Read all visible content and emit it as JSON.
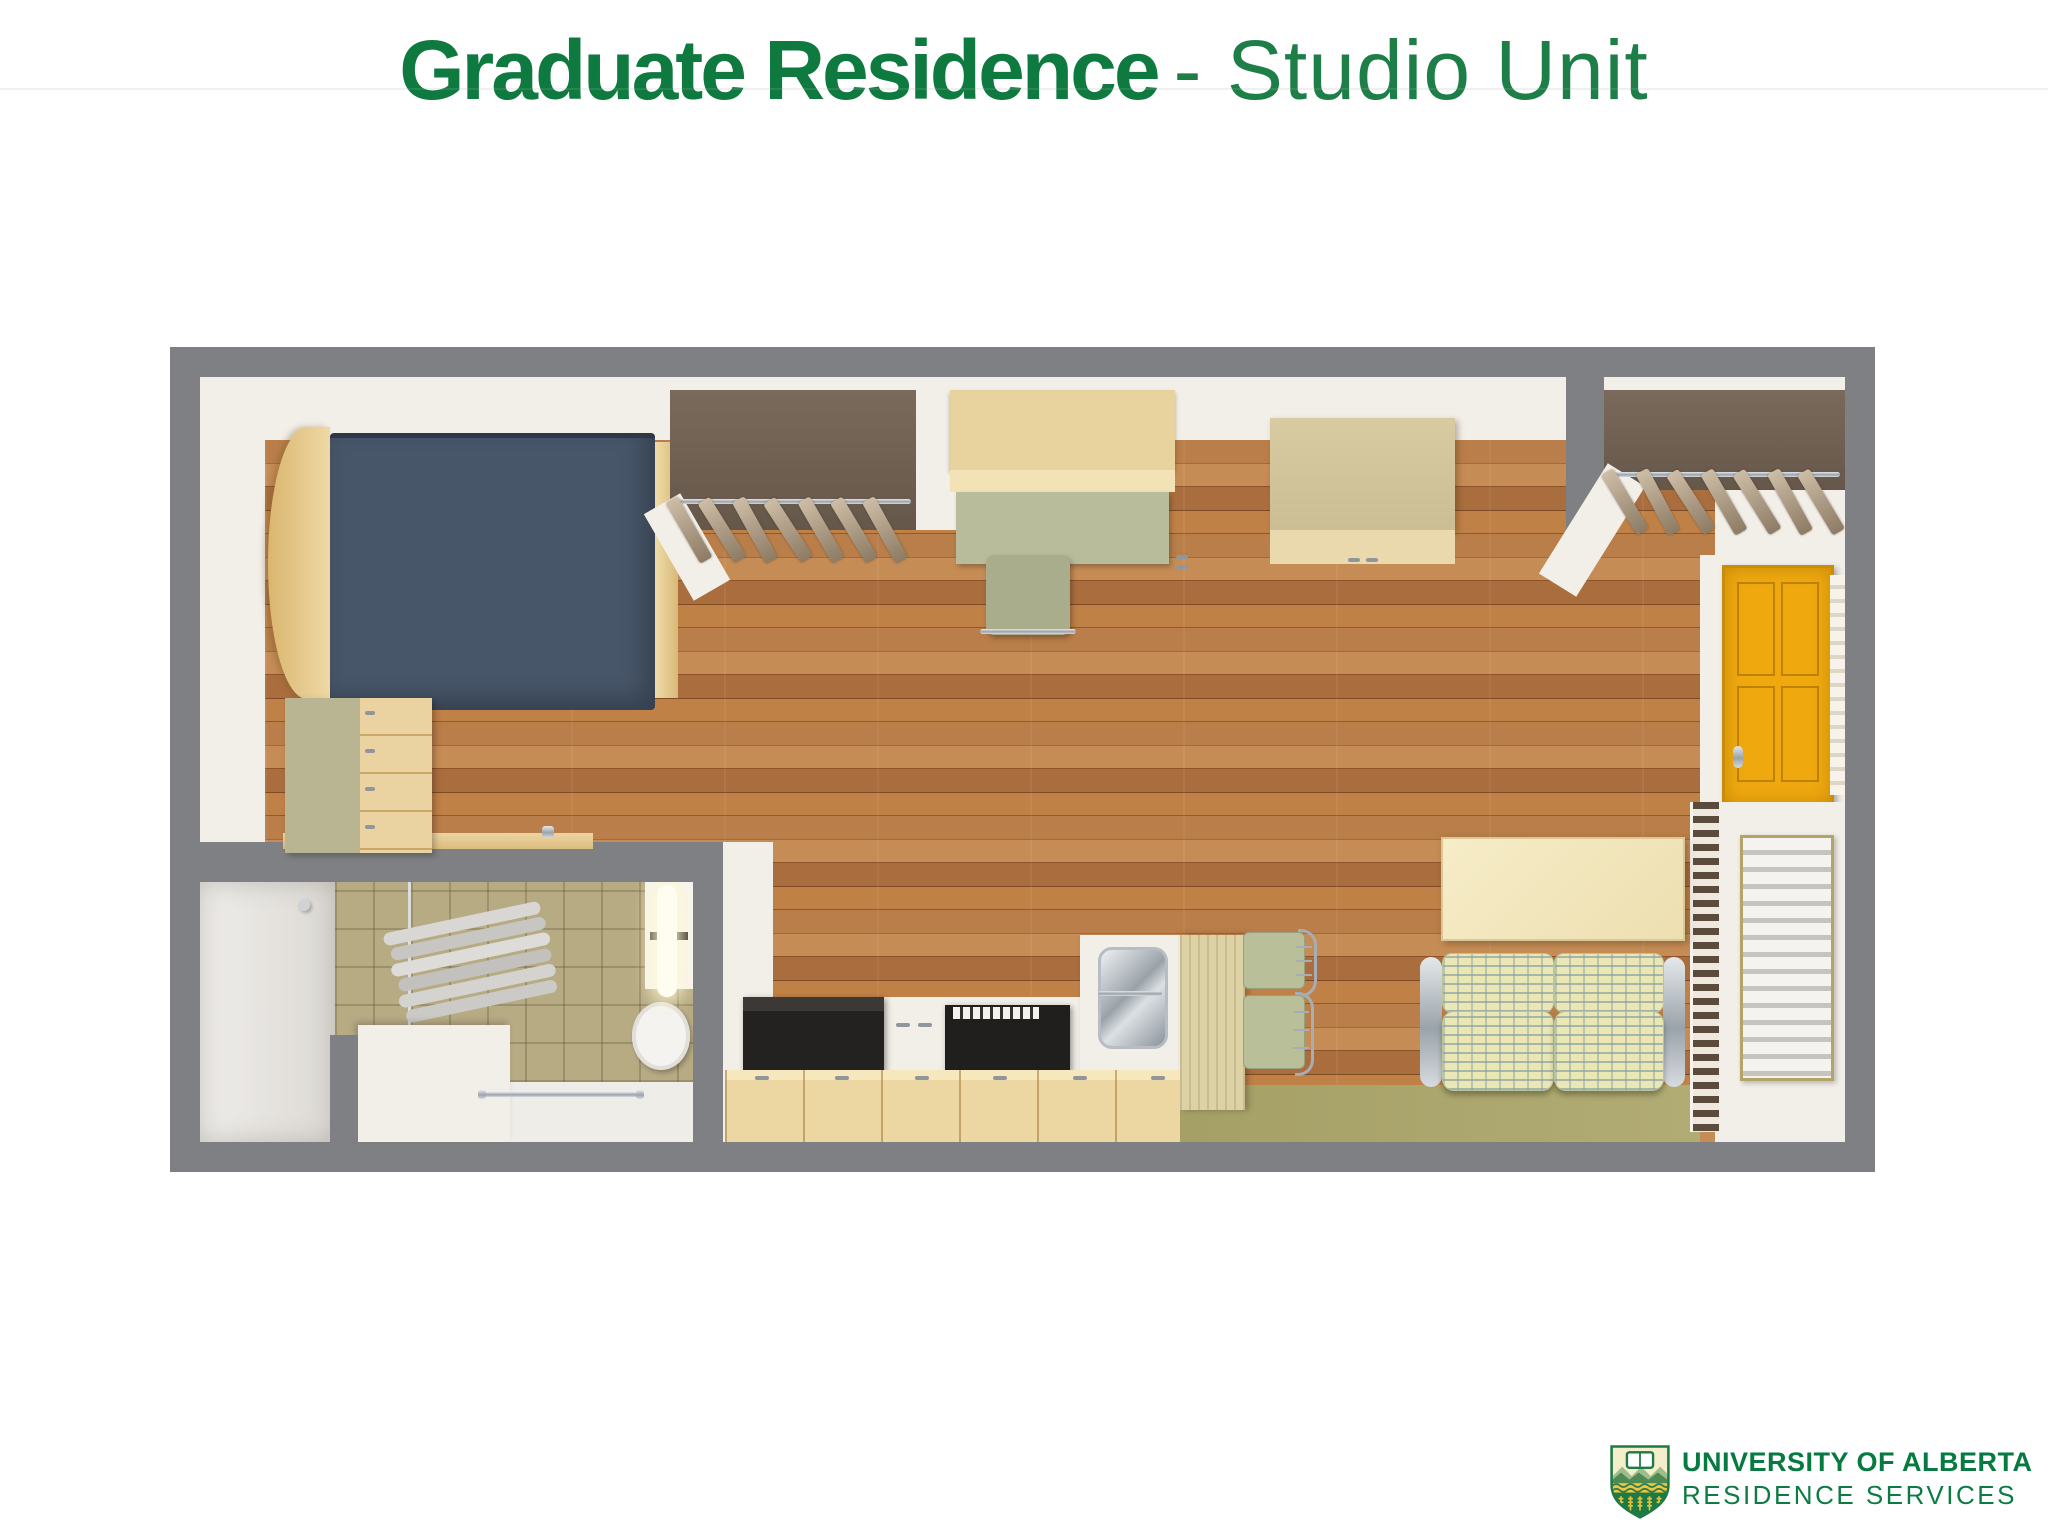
{
  "title": {
    "emphasis": "Graduate Residence",
    "rest": "- Studio Unit"
  },
  "logo": {
    "line1": "UNIVERSITY OF ALBERTA",
    "line2": "RESIDENCE SERVICES"
  },
  "palette": {
    "brand_green": "#0e7a3f",
    "frame_gray": "#7e8083",
    "wall_white": "#f2eee8",
    "wood_floor": "#b97e49",
    "carpet_olive": "#a9a46c",
    "bed_navy": "#475669",
    "door_yellow": "#efa90f",
    "couch_fabric": "#eae7b4",
    "maple_wood": "#ead3a0",
    "tile_beige": "#b7ab84",
    "shield_gold": "#f2c53d",
    "shield_cream": "#f5eecb"
  },
  "floorplan": {
    "unit_type": "Studio Unit",
    "rooms": [
      "sleeping-area",
      "closet-left",
      "study-area",
      "storage",
      "closet-entry",
      "entry",
      "bathroom",
      "kitchen",
      "dining-area",
      "living-area"
    ],
    "furniture": [
      "bed",
      "curved-headboard",
      "wardrobe",
      "hanger-rod",
      "clothes-hangers",
      "desk-with-hutch",
      "desk-chair",
      "overhead-cabinet",
      "entry-door",
      "door-sidelight",
      "utility-vent",
      "louvered-panel",
      "wall-mounted-table",
      "loveseat",
      "dining-chairs",
      "kitchen-island",
      "kitchen-sink",
      "range",
      "refrigerator",
      "base-cabinets",
      "toilet",
      "shower",
      "towel-stack",
      "vanity-light",
      "grab-bar",
      "vanity-counter"
    ]
  }
}
